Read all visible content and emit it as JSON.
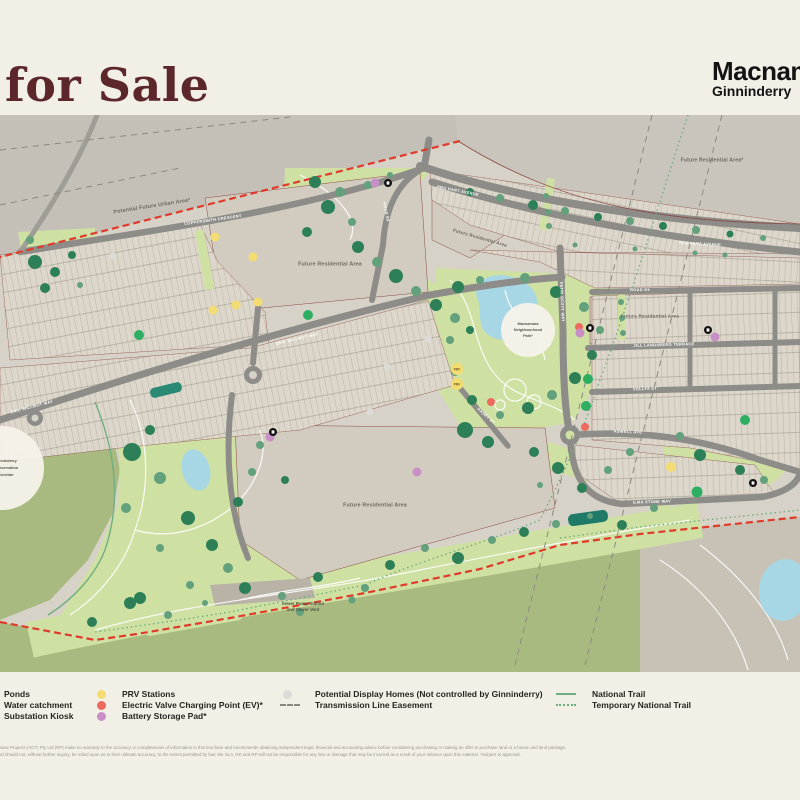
{
  "header": {
    "title": "for Sale",
    "brand_primary": "Macnamara",
    "brand_secondary": "Ginninderry"
  },
  "map": {
    "area_labels": [
      {
        "text": "Potential Future Urban Area*"
      },
      {
        "text": "Future Residential Area*"
      },
      {
        "text": "Future Residential Area"
      },
      {
        "text": "Future Residential Area"
      },
      {
        "text": "Future Residential Area"
      },
      {
        "text": "Future Residential Area"
      }
    ],
    "street_labels": [
      {
        "text": "PRO HART AVENUE"
      },
      {
        "text": "PRO HART AVENUE"
      },
      {
        "text": "ROAD E8"
      },
      {
        "text": "ROAD E9"
      },
      {
        "text": "JILL LANDSBERG TERRACE"
      },
      {
        "text": "SOLLYA ST"
      },
      {
        "text": "ASWELL AVE"
      },
      {
        "text": "ILMA STONE WAY"
      },
      {
        "text": "PATRI SCOTT WAY"
      },
      {
        "text": "ERIC WILLMOT WAY"
      },
      {
        "text": "ERIC WILLMOT WAY"
      },
      {
        "text": "COPPERSMITH CRESCENT"
      },
      {
        "text": "KASEY ST"
      }
    ],
    "poi": {
      "park_circle": {
        "lines": [
          "Macnamara",
          "Neighbourhood",
          "Park*"
        ]
      },
      "conservation_circle": {
        "lines": [
          "Ginninderry",
          "Conservation",
          "Corridor"
        ]
      },
      "sewer": {
        "lines": [
          "Sewer Pump Station",
          "and Sewer Vent"
        ]
      },
      "prv_label": "PRV"
    }
  },
  "legend": {
    "columns": [
      {
        "items": [
          {
            "label": "Ponds"
          },
          {
            "label": "Water catchment"
          },
          {
            "label": "Substation Kiosk"
          }
        ]
      },
      {
        "items": [
          {
            "label": "PRV Stations"
          },
          {
            "label": "Electric Valve Charging Point (EV)*"
          },
          {
            "label": "Battery Storage Pad*"
          }
        ]
      },
      {
        "items": [
          {
            "label": "Potential Display Homes (Not controlled by Ginninderry)"
          },
          {
            "label": "Transmission Line Easement"
          }
        ]
      },
      {
        "items": [
          {
            "label": "National Trail"
          },
          {
            "label": "Temporary National Trail"
          }
        ]
      }
    ]
  },
  "colors": {
    "title_maroon": "#5c272b",
    "boundary_red": "#e03a2a",
    "prv_yellow": "#f3dc72",
    "ev_red": "#ed6a5e",
    "battery_purple": "#c78fc5",
    "display_home_gray": "#dcdbd7",
    "trail_green": "#6fae7e",
    "pond_blue": "#a7d7e4",
    "park_green": "#cfe0a3",
    "conservation_olive": "#a9ba80"
  },
  "disclaimer": {
    "line1": "developments (RD) and Riverview Projects (ACT) Pty Ltd (RP) make no warranty to the accuracy or completeness of information in this brochure and recommends obtaining independent legal, financial and accounting advice before considering purchasing or making an offer to purchase land or a house and land package.",
    "line2": "or illustrative purposes only and should not, without further inquiry, be relied upon as to their ultimate accuracy, to the extent permitted by law; the SLA, RD and RP will not be responsible for any loss or damage that may be incurred as a result of your reliance upon this material. *Subject to approval."
  }
}
